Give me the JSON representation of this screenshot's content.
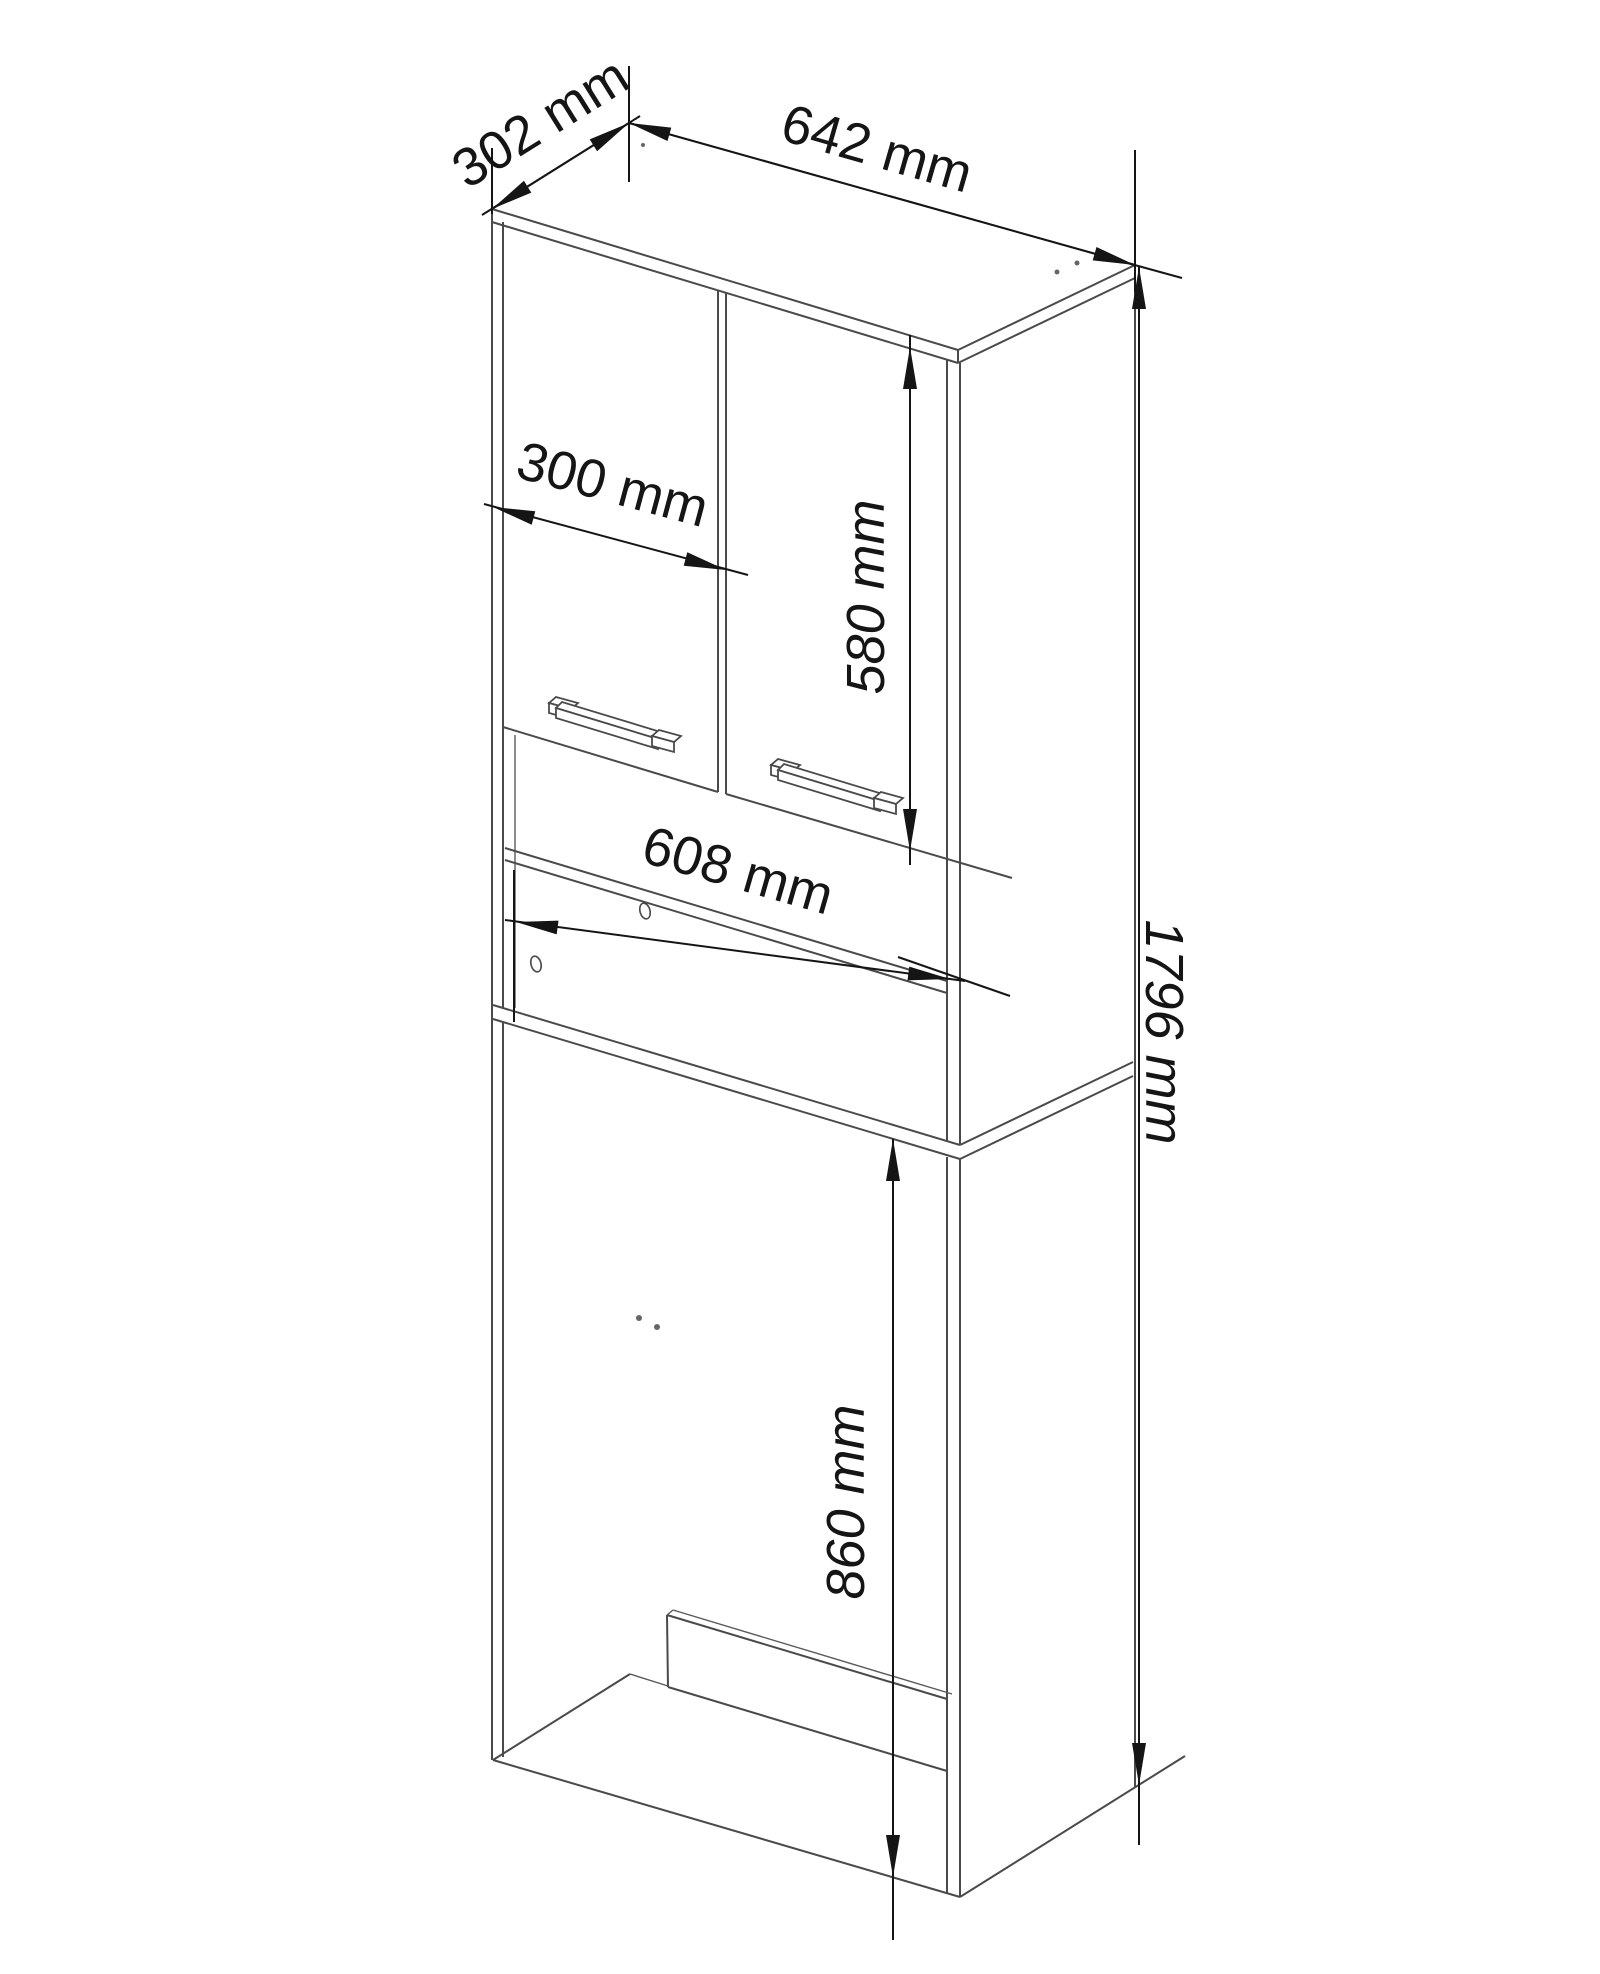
{
  "page": {
    "background": "#ffffff"
  },
  "drawing": {
    "type": "furniture-technical-drawing",
    "subject": "tall-bathroom-cabinet-over-washing-machine",
    "unit": "mm",
    "colors": {
      "line": "#4a4a4a",
      "dimension": "#151515",
      "background": "#ffffff"
    },
    "labels": {
      "depth": "302 mm",
      "width": "642 mm",
      "door_width": "300 mm",
      "door_height": "580 mm",
      "inner_width": "608 mm",
      "total_height": "1796 mm",
      "washer_space_height": "860 mm"
    }
  }
}
